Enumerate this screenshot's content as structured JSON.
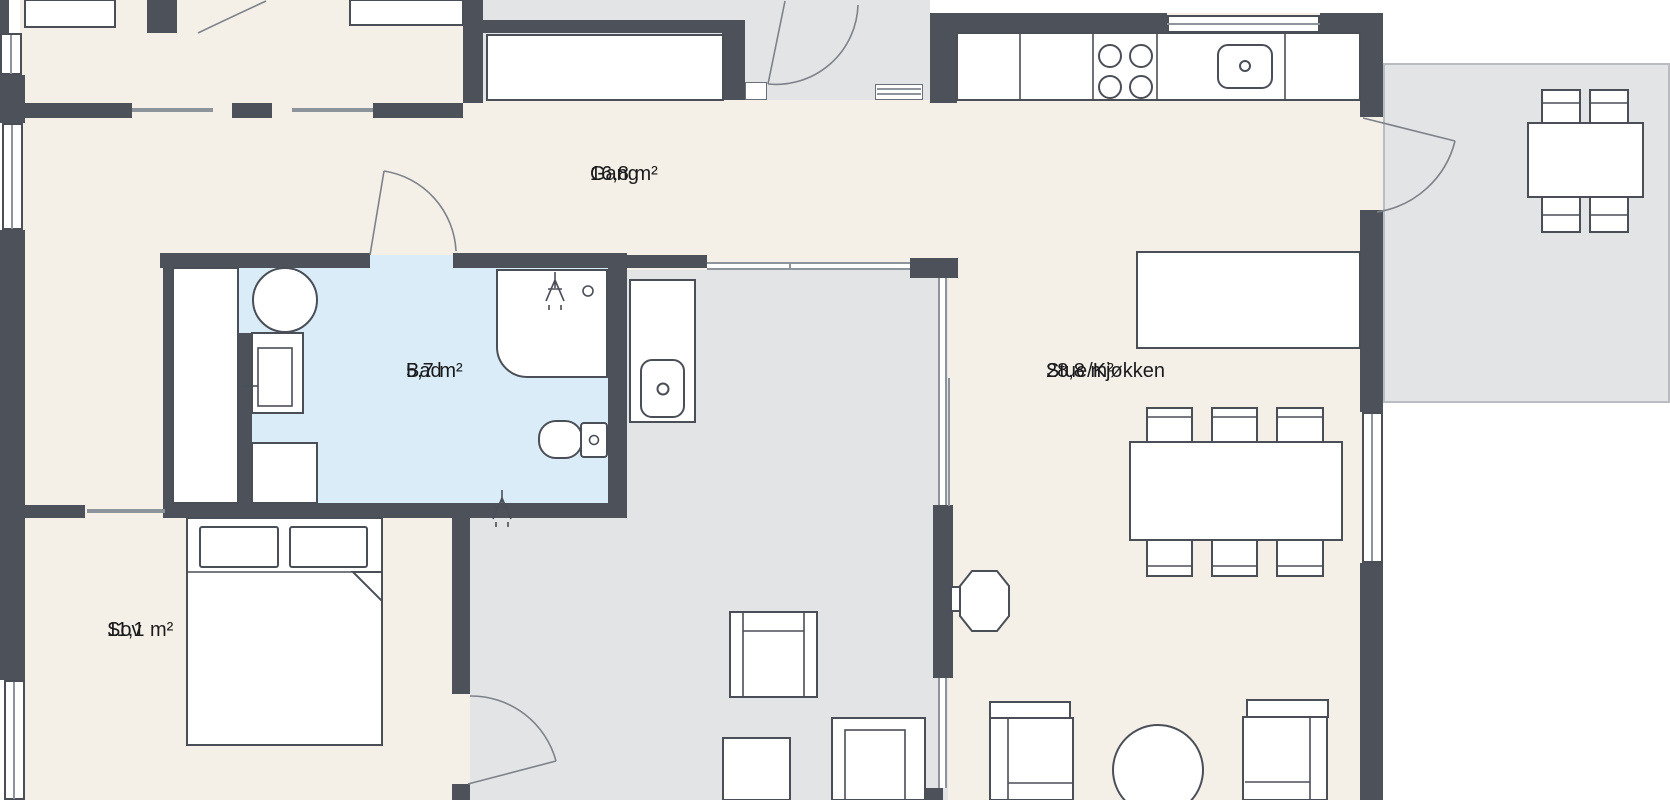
{
  "plan": {
    "rooms": [
      {
        "id": "gang",
        "name": "Gang",
        "area": "16,8 m²"
      },
      {
        "id": "bad",
        "name": "Bad",
        "area": "5,7 m²"
      },
      {
        "id": "stue-kjokken",
        "name": "Stue/Kjøkken",
        "area": "28,8 m²"
      },
      {
        "id": "sov",
        "name": "Sov",
        "area": "11,1 m²"
      }
    ],
    "colors": {
      "wall": "#4d525a",
      "outline": "#4a4f57",
      "floor": "#f4f0e8",
      "floor2": "#e3e4e6",
      "bath": "#d9ecf7",
      "glass": "#8e949c",
      "text": "#1b1b1d",
      "bg": "#ffffff"
    },
    "fixtures": [
      "entry-door",
      "bathroom-door",
      "bedroom-door",
      "terrace-door",
      "sliding-door",
      "glass-partition",
      "window",
      "wardrobe",
      "closet",
      "kitchen-counter",
      "stove-burners",
      "kitchen-sink",
      "kitchen-island",
      "dining-table",
      "dining-chair",
      "wood-stove",
      "armchair",
      "sofa",
      "round-table",
      "bed",
      "pillow",
      "washing-machine",
      "bathroom-cabinet",
      "shower",
      "shower-head-icon",
      "sprinkler-icon",
      "toilet",
      "vanity-sink",
      "outdoor-table",
      "outdoor-chair"
    ]
  }
}
